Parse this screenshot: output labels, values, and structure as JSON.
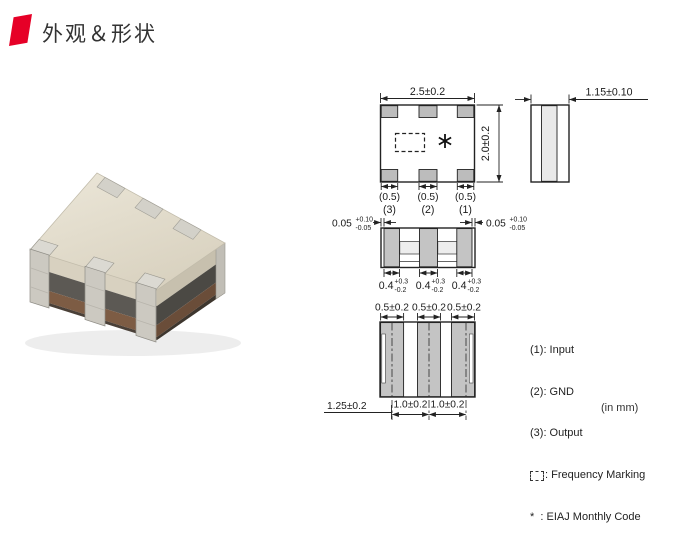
{
  "header": {
    "title": "外观＆形状",
    "accent_color": "#e60027"
  },
  "photo": {
    "description": "ceramic-smd-filter-component"
  },
  "drawings": {
    "top_view": {
      "width_dim": "2.5±0.2",
      "height_dim": "2.0±0.2",
      "pad_width_dim": "(0.5)",
      "pad_numbers": [
        "(3)",
        "(2)",
        "(1)"
      ],
      "marking_symbol": "*"
    },
    "side_view": {
      "thickness_dim": "1.15±0.10"
    },
    "front_view": {
      "edge_gap": {
        "value": "0.05",
        "plus": "+0.10",
        "minus": "-0.05"
      },
      "terminal_width": {
        "value": "0.4",
        "plus": "+0.3",
        "minus": "-0.2"
      }
    },
    "bottom_view": {
      "land_width_dim": "0.5±0.2",
      "pitch_dim": "1.0±0.2",
      "offset_dim": "1.25±0.2"
    },
    "legend": {
      "items": [
        {
          "text": "(1): Input"
        },
        {
          "text": "(2): GND"
        },
        {
          "text": "(3): Output"
        },
        {
          "text": ": Frequency Marking",
          "icon": "dashed-box"
        },
        {
          "text": "*  : EIAJ Monthly Code"
        }
      ]
    },
    "units_note": "(in mm)"
  },
  "colors": {
    "accent": "#e60027",
    "pad_gray": "#bcbcbc",
    "terminal_gray": "#c4c4c4",
    "line": "#222222",
    "body_beige": "#ded7c6",
    "layer_dark": "#5c5954",
    "layer_brown": "#7d5c44"
  }
}
